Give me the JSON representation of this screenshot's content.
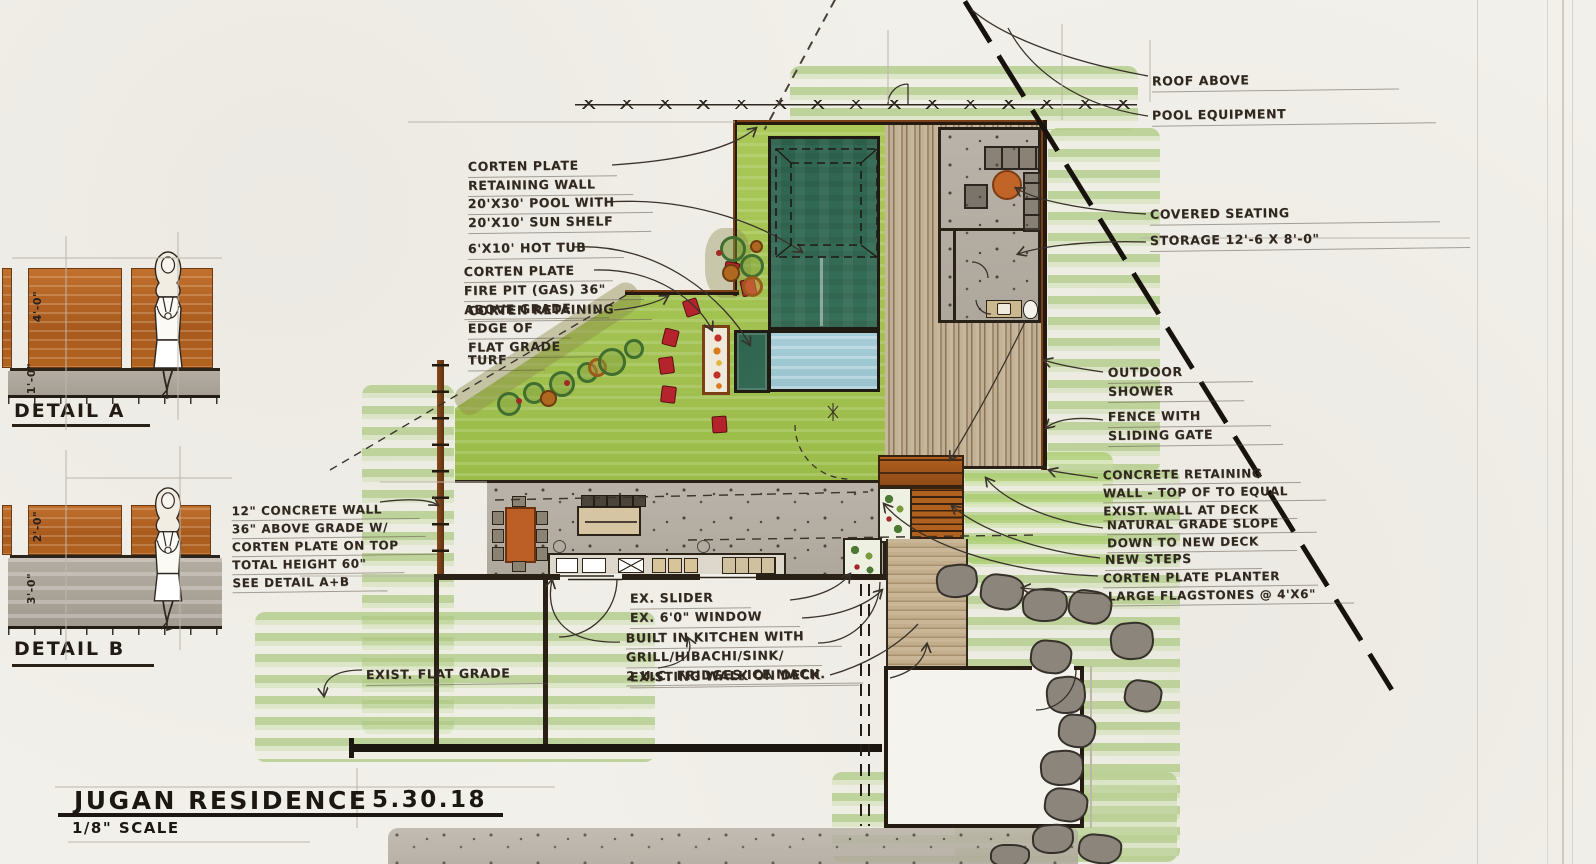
{
  "sheet": {
    "project": "JUGAN RESIDENCE",
    "date": "5.30.18",
    "scale": "1/8\" SCALE"
  },
  "details": {
    "a": {
      "label": "DETAIL A",
      "wall_height": "4'-0\"",
      "base_height": "1'-0\""
    },
    "b": {
      "label": "DETAIL B",
      "corten_height": "2'-0\"",
      "wall_height": "3'-0\""
    }
  },
  "annotations": {
    "corten_wall": {
      "lines": [
        "CORTEN PLATE",
        "RETAINING WALL"
      ]
    },
    "pool": {
      "lines": [
        "20'X30' POOL WITH",
        "20'X10' SUN SHELF"
      ]
    },
    "hot_tub": {
      "lines": [
        "6'X10' HOT TUB"
      ]
    },
    "fire_pit": {
      "lines": [
        "CORTEN PLATE",
        "FIRE PIT (GAS) 36\"",
        "ABOVE GRADE"
      ]
    },
    "corten_retaining": {
      "lines": [
        "CORTEN RETAINING"
      ]
    },
    "edge_of_flat_grade": {
      "lines": [
        "EDGE OF",
        "FLAT GRADE"
      ]
    },
    "turf": {
      "lines": [
        "TURF"
      ]
    },
    "roof_above": {
      "lines": [
        "ROOF ABOVE"
      ]
    },
    "pool_equipment": {
      "lines": [
        "POOL EQUIPMENT"
      ]
    },
    "covered_seating": {
      "lines": [
        "COVERED SEATING"
      ]
    },
    "storage": {
      "lines": [
        "STORAGE 12'-6 X 8'-0\""
      ]
    },
    "outdoor_shower": {
      "lines": [
        "OUTDOOR",
        "SHOWER"
      ]
    },
    "fence_gate": {
      "lines": [
        "FENCE WITH",
        "SLIDING GATE"
      ]
    },
    "concrete_retaining": {
      "lines": [
        "CONCRETE RETAINING",
        "WALL - TOP OF TO EQUAL",
        "EXIST. WALL AT DECK"
      ]
    },
    "natural_grade": {
      "lines": [
        "NATURAL GRADE SLOPE",
        "DOWN TO NEW DECK"
      ]
    },
    "new_steps": {
      "lines": [
        "NEW STEPS"
      ]
    },
    "corten_planter": {
      "lines": [
        "CORTEN PLATE PLANTER"
      ]
    },
    "flagstones": {
      "lines": [
        "LARGE FLAGSTONES @ 4'X6\""
      ]
    },
    "concrete_wall_note": {
      "lines": [
        "12\" CONCRETE WALL",
        "36\" ABOVE GRADE W/",
        "CORTEN PLATE ON TOP",
        "TOTAL HEIGHT 60\"",
        "SEE DETAIL A+B"
      ]
    },
    "ex_slider": {
      "lines": [
        "EX. SLIDER"
      ]
    },
    "ex_window": {
      "lines": [
        "EX. 6'0\" WINDOW"
      ]
    },
    "built_in_kitchen": {
      "lines": [
        "BUILT IN KITCHEN WITH",
        "GRILL/HIBACHI/SINK/",
        "2 U.C. FRIDGES/ICE MACH."
      ]
    },
    "existing_walk": {
      "lines": [
        "EXISTING WALK ON DECK"
      ]
    },
    "exist_flat_grade": {
      "lines": [
        "EXIST. FLAT GRADE"
      ]
    }
  },
  "palette": {
    "corten": "#b0601f",
    "pool_green": "#2e6450",
    "sun_shelf_blue": "#a7ced8",
    "turf_green": "#a6c653",
    "grass_light": "#cfe0b0",
    "concrete_gray": "#b6afa5",
    "marker_red": "#b5242c",
    "table_orange": "#bb5f27"
  }
}
